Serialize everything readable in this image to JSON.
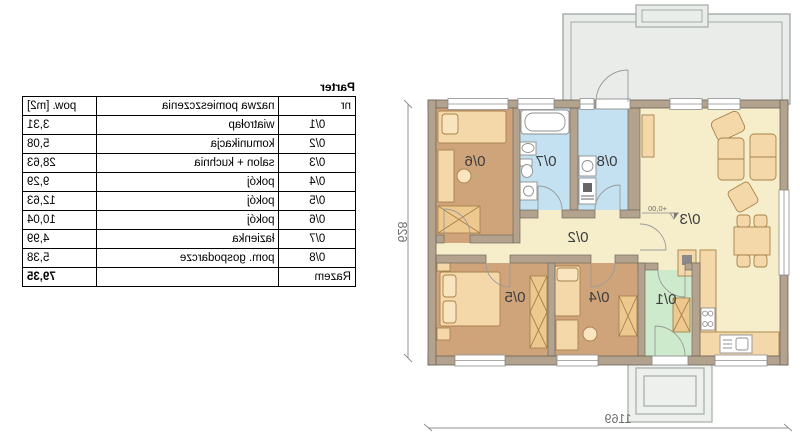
{
  "table": {
    "title": "Parter",
    "headers": {
      "nr": "nr",
      "name": "nazwa pomieszczenia",
      "area": "pow. [m2]"
    },
    "rows": [
      {
        "nr": "0/1",
        "name": "wiatrołap",
        "area": "3,31"
      },
      {
        "nr": "0/2",
        "name": "komunikacja",
        "area": "5,08"
      },
      {
        "nr": "0/3",
        "name": "salon + kuchnia",
        "area": "28,63"
      },
      {
        "nr": "0/4",
        "name": "pokój",
        "area": "9,29"
      },
      {
        "nr": "0/5",
        "name": "pokój",
        "area": "12,63"
      },
      {
        "nr": "0/6",
        "name": "pokój",
        "area": "10,04"
      },
      {
        "nr": "0/7",
        "name": "łazienka",
        "area": "4,99"
      },
      {
        "nr": "0/8",
        "name": "pom. gospodarcze",
        "area": "5,38"
      }
    ],
    "total": {
      "label": "Razem",
      "area": "79,35"
    }
  },
  "plan": {
    "labels": {
      "r1": "0/1",
      "r2": "0/2",
      "r3": "0/3",
      "r4": "0/4",
      "r5": "0/5",
      "r6": "0/6",
      "r7": "0/7",
      "r8": "0/8"
    },
    "level_marker": "+0,00",
    "dimensions": {
      "width": "1169",
      "height": "628"
    },
    "colors": {
      "wall": "#b2a28e",
      "bedroom": "#d0a47a",
      "living": "#f6eecb",
      "bath": "#c4e1f1",
      "entry": "#cdeacc",
      "terrace": "#e9ece9",
      "furniture": "#f5d8a9"
    }
  }
}
